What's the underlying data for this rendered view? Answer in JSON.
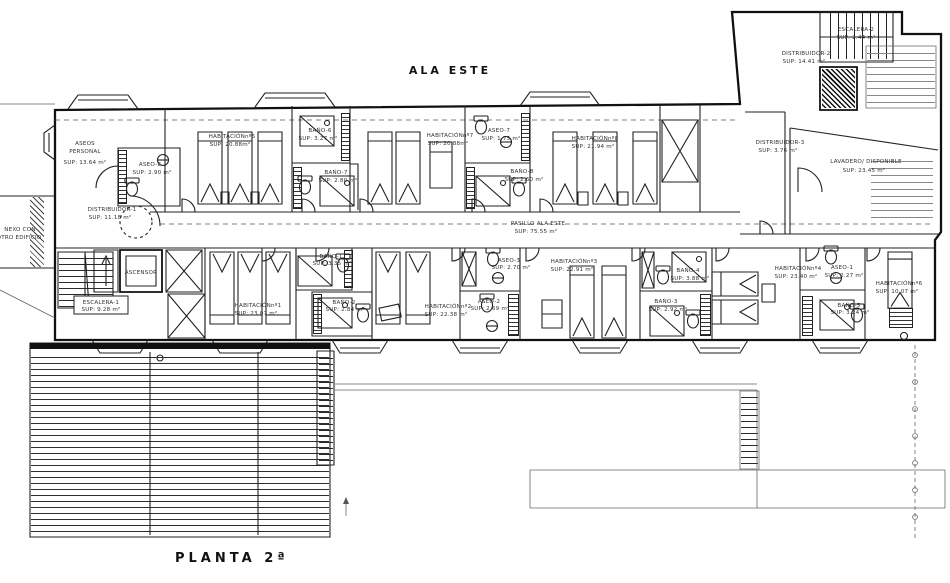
{
  "meta": {
    "background": "#ffffff",
    "ink": "#1c1c1c"
  },
  "title": "ALA ESTE",
  "floor_label": "PLANTA 2ª",
  "connector": {
    "l1": "NEXO CON",
    "l2": "OTRO EDIFICIO"
  },
  "corridor": {
    "l1": "PASILLO ALA ESTE",
    "l2": "SUP: 75.55 m²"
  },
  "rooms": {
    "aseos_personal": {
      "l1": "ASEOS",
      "l2": "PERSONAL",
      "l3": "SUP: 13.64 m²"
    },
    "aseo8": {
      "l1": "ASEO-8",
      "l2": "SUP: 2.90 m²"
    },
    "hab5": {
      "l1": "HABITACIÓNnº5",
      "l2": "SUP: 20.88m²"
    },
    "bano6": {
      "l1": "BAÑO-6",
      "l2": "SUP: 3.27 m²"
    },
    "bano7": {
      "l1": "BAÑO-7",
      "l2": "SUP: 2.80 m²"
    },
    "hab7": {
      "l1": "HABITACIÓNnº7",
      "l2": "SUP: 20.88m²"
    },
    "aseo7": {
      "l1": "ASEO-7",
      "l2": "SUP: 1.75 m²"
    },
    "bano8": {
      "l1": "BAÑO-8",
      "l2": "SUP: 2.60 m²"
    },
    "hab8": {
      "l1": "HABITACIÓNnº8",
      "l2": "SUP: 21.94 m²"
    },
    "escalera2": {
      "l1": "ESCALERA-2",
      "l2": "SUP: 2.44 m²"
    },
    "distribuidor2": {
      "l1": "DISTRIBUIDOR-2",
      "l2": "SUP: 14.41 m²"
    },
    "distribuidor3": {
      "l1": "DISTRIBUIDOR-3",
      "l2": "SUP: 3.76 m²"
    },
    "lavadero": {
      "l1": "LAVADERO/ DISPONIBLE",
      "l2": "SUP: 23.45 m²"
    },
    "distribuidor1": {
      "l1": "DISTRIBUIDOR-1",
      "l2": "SUP: 11.18 m²"
    },
    "ascensor": {
      "l1": "ASCENSOR"
    },
    "escalera1": {
      "l1": "ESCALERA-1",
      "l2": "SUP: 9.28 m²"
    },
    "hab1": {
      "l1": "HABITACIÓNnº1",
      "l2": "SUP: 23.07 m²"
    },
    "bano1": {
      "l1": "BAÑO-1",
      "l2": "SUP: 3.35 m²"
    },
    "bano2": {
      "l1": "BAÑO-2",
      "l2": "SUP: 2.84 m²"
    },
    "hab2": {
      "l1": "HABITACIÓNnº2",
      "l2": "SUP: 22.38 m²"
    },
    "aseo3": {
      "l1": "ASEO-3",
      "l2": "SUP: 2.70 m²"
    },
    "aseo2": {
      "l1": "ASEO-2",
      "l2": "SUP: 2.69 m²"
    },
    "hab3": {
      "l1": "HABITACIÓNnº3",
      "l2": "SUP: 22.91 m²"
    },
    "bano4": {
      "l1": "BAÑO-4",
      "l2": "SUP: 3.88 m²"
    },
    "bano3": {
      "l1": "BAÑO-3",
      "l2": "SUP: 2.92 m²"
    },
    "hab4": {
      "l1": "HABITACIÓNnº4",
      "l2": "SUP: 23.40 m²"
    },
    "aseo1": {
      "l1": "ASEO-1",
      "l2": "SUP: 2.27 m²"
    },
    "bano5": {
      "l1": "BAÑO-5",
      "l2": "SUP: 3.24 m²"
    },
    "hab6": {
      "l1": "HABITACIÓNnº6",
      "l2": "SUP: 10.07 m²"
    }
  }
}
